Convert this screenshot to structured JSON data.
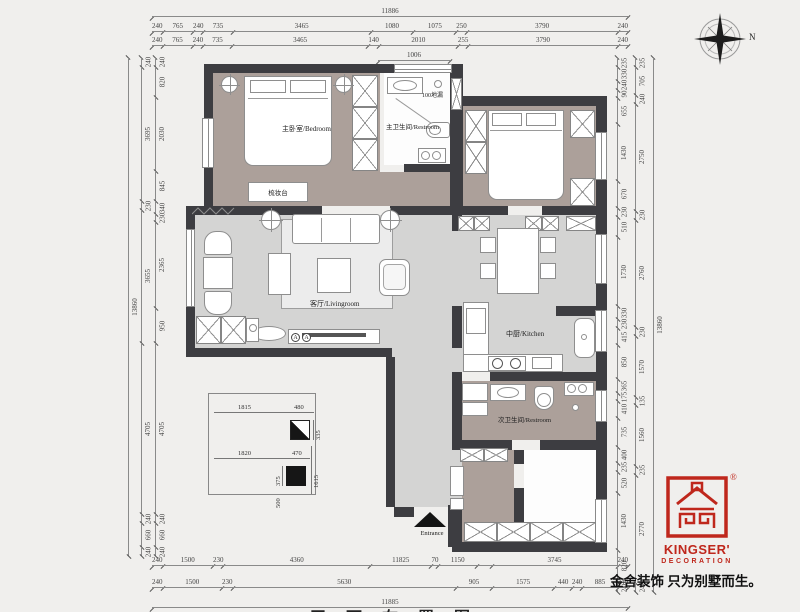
{
  "page": {
    "bg": "#f0efed"
  },
  "colors": {
    "wall": "#3d3d41",
    "floor_warm": "#aca09a",
    "floor_cool": "#d4d4d3",
    "accent_red": "#bf271c"
  },
  "compass": {
    "north_label": "N"
  },
  "rooms": {
    "master_bedroom": "主卧室/Bedroom",
    "master_bathroom": "主卫生间/Restroom",
    "dressing_table": "梳妆台",
    "living_room": "客厅/Livingroom",
    "kitchen": "中厨/Kitchen",
    "second_bathroom": "次卫生间/Restroom",
    "entrance": "Entrance",
    "floor_drain": "100地漏",
    "section_mark": "A"
  },
  "dims": {
    "rows": [
      {
        "id": "top-total",
        "labels": [
          "11886"
        ]
      },
      {
        "id": "top-1",
        "labels": [
          "240",
          "765",
          "240",
          "735",
          "3465",
          "1080",
          "1075",
          "250",
          "3790",
          "240"
        ]
      },
      {
        "id": "top-2",
        "labels": [
          "240",
          "765",
          "240",
          "735",
          "3465",
          "140",
          "2010",
          "255",
          "3790",
          "240"
        ]
      },
      {
        "id": "bath-top",
        "labels": [
          "1006"
        ]
      },
      {
        "id": "bot-1",
        "labels": [
          "240",
          "1500",
          "230",
          "4360",
          "11825",
          "70",
          "1150",
          "",
          "3745",
          "240"
        ],
        "w": [
          240,
          1500,
          230,
          4360,
          1825,
          70,
          1150,
          430,
          3745,
          240
        ]
      },
      {
        "id": "bot-2",
        "labels": [
          "240",
          "1500",
          "230",
          "5630",
          "905",
          "1575",
          "440",
          "240",
          "885",
          "240"
        ]
      },
      {
        "id": "bot-total",
        "labels": [
          "11885"
        ]
      },
      {
        "id": "left-total",
        "labels": [
          "13860"
        ]
      },
      {
        "id": "left-outer",
        "labels": [
          "240",
          "3695",
          "230",
          "3655",
          "4705",
          "240",
          "660",
          "240"
        ]
      },
      {
        "id": "left-inner",
        "labels": [
          "240",
          "820",
          "2030",
          "845",
          "340",
          "230",
          "2365",
          "950",
          "4705",
          "240",
          "660",
          "240"
        ]
      },
      {
        "id": "right-inner",
        "labels": [
          "235",
          "330",
          "240",
          "90",
          "655",
          "1430",
          "670",
          "230",
          "510",
          "1730",
          "330",
          "230",
          "415",
          "850",
          "365",
          "175",
          "410",
          "735",
          "400",
          "235",
          "520",
          "1430",
          "820",
          "240"
        ]
      },
      {
        "id": "right-outer",
        "labels": [
          "235",
          "705",
          "240",
          "2750",
          "230",
          "2760",
          "230",
          "1570",
          "135",
          "1560",
          "235",
          "2770",
          "240"
        ]
      },
      {
        "id": "right-total",
        "labels": [
          "13860"
        ]
      }
    ]
  },
  "inset": {
    "w1815": "1815",
    "w480": "480",
    "h335": "335",
    "w1820": "1820",
    "w470": "470",
    "h375": "375",
    "h500": "500",
    "h1615": "1615"
  },
  "brand": {
    "registered": "®",
    "name": "KINGSER'",
    "subtitle": "DECORATION",
    "slogan": "金舍装饰 只为别墅而生。"
  },
  "footer": {
    "partial_title": "平面布置图"
  }
}
